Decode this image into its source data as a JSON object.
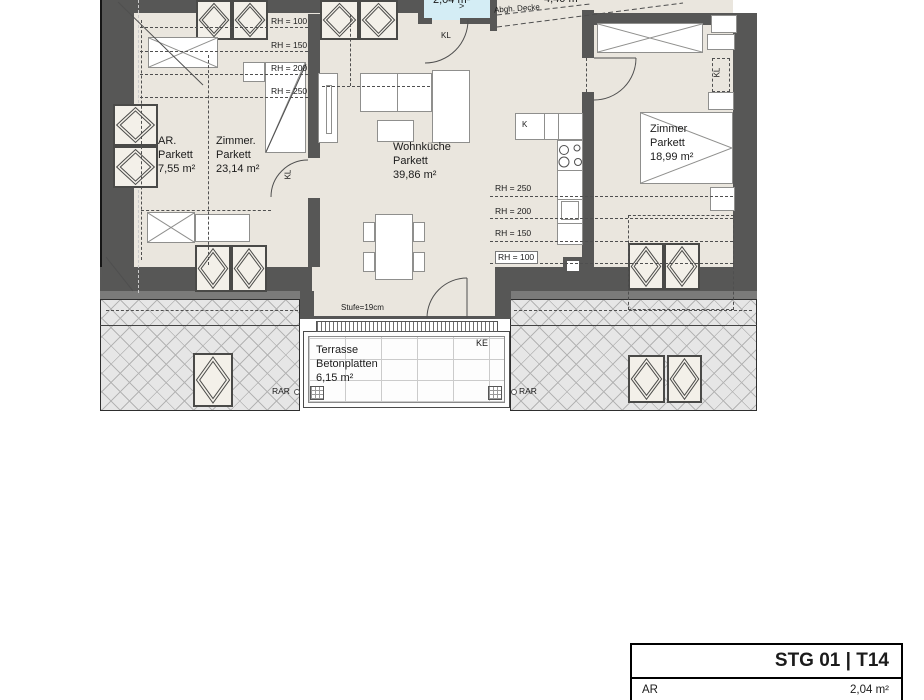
{
  "colors": {
    "wall": "#575756",
    "floor": "#eae6de",
    "wet_room": "#d4edf5",
    "hatch_bg": "#e6e6e6",
    "line": "#1d1d1b"
  },
  "rooms": {
    "ar": {
      "name": "AR.",
      "floor": "Parkett",
      "area": "7,55 m²"
    },
    "zimmer_left": {
      "name": "Zimmer.",
      "floor": "Parkett",
      "area": "23,14 m²"
    },
    "wohnkueche": {
      "name": "Wohnküche",
      "floor": "Parkett",
      "area": "39,86 m²"
    },
    "zimmer_right": {
      "name": "Zimmer",
      "floor": "Parkett",
      "area": "18,99 m²"
    },
    "terrasse": {
      "name": "Terrasse",
      "floor": "Betonplatten",
      "area": "6,15 m²"
    },
    "bad": {
      "area": "2,04 m²"
    },
    "flur": {
      "area": "4,40 m²"
    }
  },
  "annotations": {
    "rh_left": [
      "RH = 100",
      "RH = 150",
      "RH = 200",
      "RH = 250"
    ],
    "rh_right": [
      "RH = 250",
      "RH = 200",
      "RH = 150",
      "RH = 100"
    ],
    "abgh_decke": "Abgh. Decke",
    "stufe": "Stufe=19cm",
    "kl": "KL",
    "ke": "KE",
    "rar": "RAR",
    "k": "K",
    "arrow": ">"
  },
  "title_block": {
    "title": "STG 01 | T14",
    "rows": [
      {
        "label": "AR",
        "value": "2,04 m²"
      }
    ]
  }
}
